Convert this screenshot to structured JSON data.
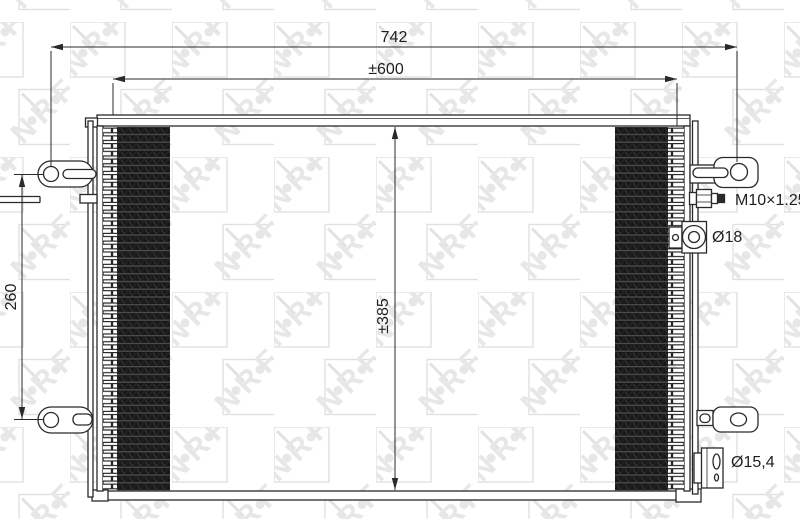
{
  "drawing": {
    "type": "technical-drawing",
    "subject": "automotive condenser front view",
    "watermark_text": "NRF",
    "dimensions": {
      "overall_width": "742",
      "core_width": "±600",
      "core_height": "±385",
      "mount_hole_spacing": "260"
    },
    "annotations": {
      "thread_spec": "M10×1.25",
      "top_port_diameter": "Ø18",
      "bottom_port_diameter": "Ø15,4"
    },
    "colors": {
      "ink": "#2a2a2a",
      "fin_dark": "#181818",
      "watermark_gray": "#e7e7e7",
      "background": "#ffffff"
    }
  }
}
